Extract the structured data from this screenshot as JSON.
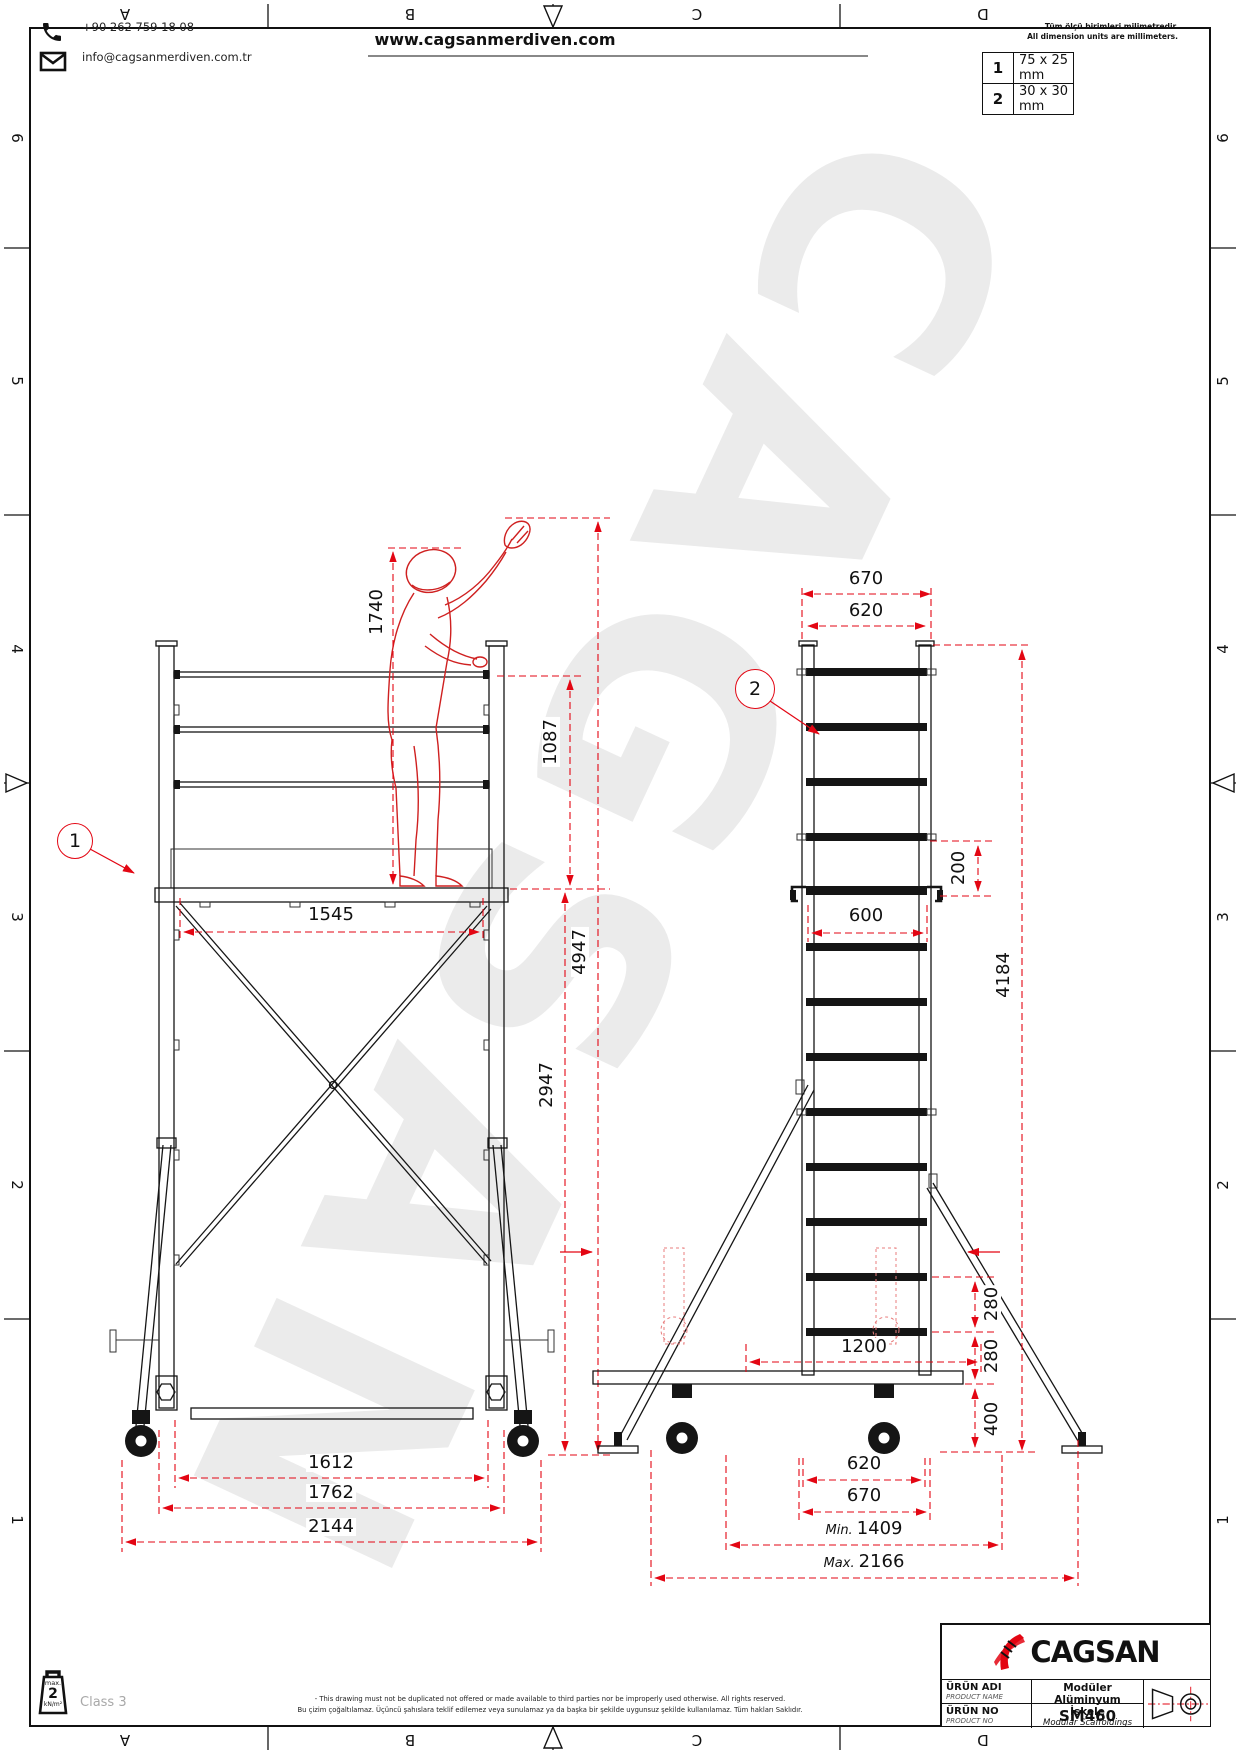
{
  "colors": {
    "dim_red": "#e30613",
    "line_black": "#151515",
    "watermark_gray": "#ebebeb",
    "logo_red": "#e30613"
  },
  "watermark": "CAGSAN",
  "frame": {
    "columns": [
      "A",
      "B",
      "C",
      "D"
    ],
    "rows": [
      "6",
      "5",
      "4",
      "3",
      "2",
      "1"
    ]
  },
  "header": {
    "phone": "+90 262 759 18 08",
    "email": "info@cagsanmerdiven.com.tr",
    "website": "www.cagsanmerdiven.com"
  },
  "units": {
    "note_tr": "Tüm ölçü birimleri milimetredir.",
    "note_en": "All dimension units are millimeters.",
    "profiles": [
      {
        "id": "1",
        "size": "75 x 25 mm"
      },
      {
        "id": "2",
        "size": "30 x 30 mm"
      }
    ]
  },
  "front_view": {
    "callout": "1",
    "dims": {
      "worker_height": "1740",
      "guardrail_height": "1087",
      "total_height": "4947",
      "platform_height": "2947",
      "platform_width": "1545",
      "base_width_inner": "1612",
      "base_width_mid": "1762",
      "base_width_outer": "2144"
    }
  },
  "side_view": {
    "callout": "2",
    "dims": {
      "frame_width_outer": "670",
      "frame_width_inner": "620",
      "rung_to_platform": "200",
      "clear_width": "600",
      "frame_height": "4184",
      "rung_pitch_upper": "280",
      "rung_pitch_lower": "280",
      "base_height": "400",
      "base_width": "1200",
      "bottom_width_inner": "620",
      "bottom_width_outer": "670",
      "min_prefix": "Min.",
      "min_spread": "1409",
      "max_prefix": "Max.",
      "max_spread": "2166"
    }
  },
  "footer": {
    "load_max_label": "max.",
    "load_value": "2",
    "load_unit": "kN/m²",
    "class_label": "Class 3",
    "disclaimer_en": "- This drawing must not be duplicated not offered or made available to third parties nor be improperly used otherwise. All rights reserved.",
    "disclaimer_tr": "Bu çizim çoğaltılamaz. Üçüncü şahıslara teklif edilemez veya sunulamaz ya da başka bir şekilde uygunsuz şekilde kullanılamaz. Tüm hakları Saklıdır."
  },
  "titleblock": {
    "brand": "CAGSAN",
    "product_name_label_tr": "ÜRÜN ADI",
    "product_name_label_en": "PRODUCT NAME",
    "product_name_tr": "Modüler Alüminyum İskele",
    "product_name_en": "Modular Scaffoldings",
    "product_no_label_tr": "ÜRÜN NO",
    "product_no_label_en": "PRODUCT NO",
    "product_no": "SM460"
  }
}
